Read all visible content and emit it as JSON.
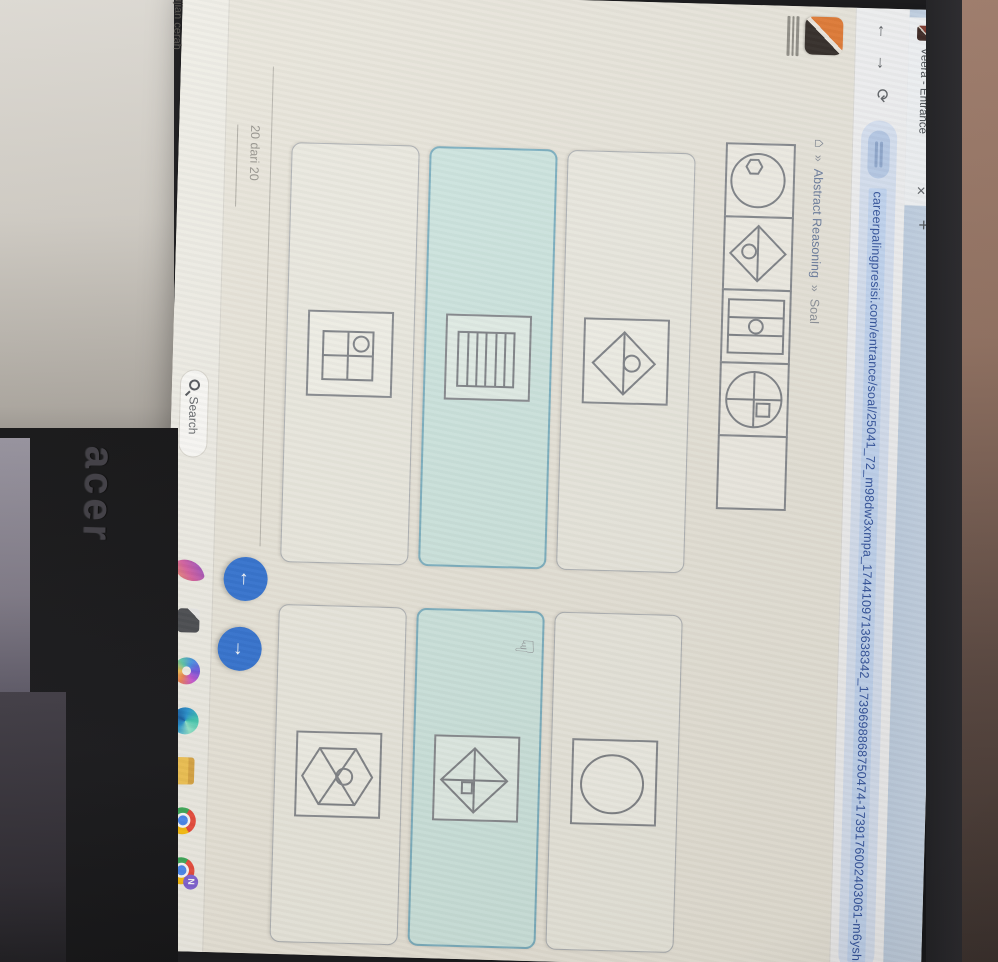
{
  "window": {
    "tab_title": "Veera - Entrance",
    "close_tab_glyph": "✕",
    "new_tab_glyph": "+"
  },
  "toolbar": {
    "back_glyph": "←",
    "forward_glyph": "→",
    "reload_glyph": "⟳",
    "url": "careerpalingpresisi.com/entrance/soal/25041_72_m98dw3xmpa_1744109713638342_1739698868750474-1739176002403061-m6yshk80"
  },
  "page": {
    "breadcrumb": {
      "home_glyph": "⌂",
      "separator": "»",
      "items": [
        {
          "label": "Abstract Reasoning"
        },
        {
          "label": "Soal"
        }
      ]
    },
    "question": {
      "cells": [
        "circle-with-small-hexagon",
        "diamond-with-horizontal-diagonal-and-circle",
        "square-three-columns-with-center-circle",
        "circle-with-cross-and-small-square",
        "empty-answer-cell"
      ]
    },
    "options": [
      {
        "icon": "diamond-with-midline-and-circle",
        "selected": false
      },
      {
        "icon": "square-with-large-circle",
        "selected": false
      },
      {
        "icon": "square-with-horizontal-stripes",
        "selected": true
      },
      {
        "icon": "diamond-with-cross-and-small-square",
        "selected": true
      },
      {
        "icon": "window-grid-with-circle-top-left",
        "selected": false
      },
      {
        "icon": "hexagon-with-x-and-circle",
        "selected": false
      }
    ],
    "pointer_hand_glyph": "☞",
    "progress_label": "20 dari 20",
    "accent_selected_color": "#cfe8e3",
    "nav_prev_glyph": "←",
    "nav_next_glyph": "→",
    "nav_button_color": "#2b6fd4"
  },
  "taskbar": {
    "search_label": "Search",
    "apps": [
      "start",
      "search",
      "design-app",
      "dark-document-app",
      "copilot",
      "edge",
      "file-explorer",
      "chrome",
      "chrome-profile"
    ],
    "chrome_profile_badge": "N"
  },
  "surroundings": {
    "laptop_brand": "acer",
    "sticker_mark": "f",
    "sticker_text": "ujian cerah"
  }
}
